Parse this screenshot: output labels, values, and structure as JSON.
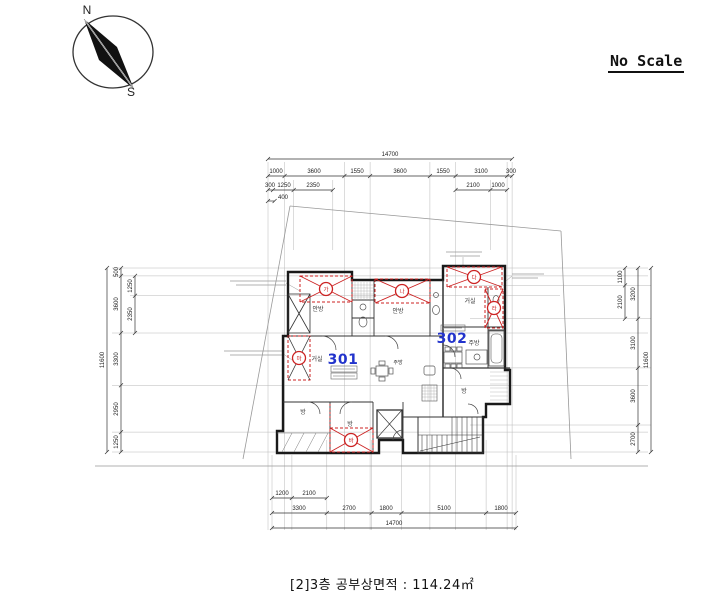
{
  "scale_note": "No Scale",
  "compass": {
    "north": "N",
    "south": "S"
  },
  "caption": "[2]3층 공부상면적 : 114.24㎡",
  "dimensions": {
    "top": {
      "overall": "14700",
      "row2": [
        "1000",
        "3600",
        "1550",
        "3600",
        "1550",
        "3100",
        "300"
      ],
      "row3": [
        "300",
        "1250",
        "2350",
        "2100",
        "1000"
      ],
      "row4": "400"
    },
    "bottom": {
      "row1": [
        "1200",
        "2100"
      ],
      "row2": [
        "3300",
        "2700",
        "1800",
        "5100",
        "1800"
      ],
      "overall": "14700"
    },
    "left": {
      "overall": "11600",
      "col_main": [
        "500",
        "3600",
        "3300",
        "2950",
        "1250"
      ],
      "col_sub": [
        "1250",
        "2350"
      ]
    },
    "right": {
      "overall": "11600",
      "col_sub": [
        "1100",
        "2100"
      ],
      "col_main": [
        "3200",
        "3100",
        "3600",
        "2700"
      ]
    }
  },
  "plan": {
    "units": [
      {
        "number": "301"
      },
      {
        "number": "302"
      }
    ],
    "rooms": {
      "bedroom1": "안방",
      "bedroom2": "안방",
      "living302": "거실",
      "living301": "거실",
      "kitchen302": "주방",
      "kitchen301": "주방",
      "room_bl": "방",
      "room_bm": "방",
      "room_r": "방"
    },
    "markers": [
      "가",
      "나",
      "다",
      "라",
      "마",
      "바"
    ]
  },
  "colors": {
    "unit_label": "#2233cc",
    "marker": "#cc2222",
    "wall": "#1a1a1a"
  }
}
